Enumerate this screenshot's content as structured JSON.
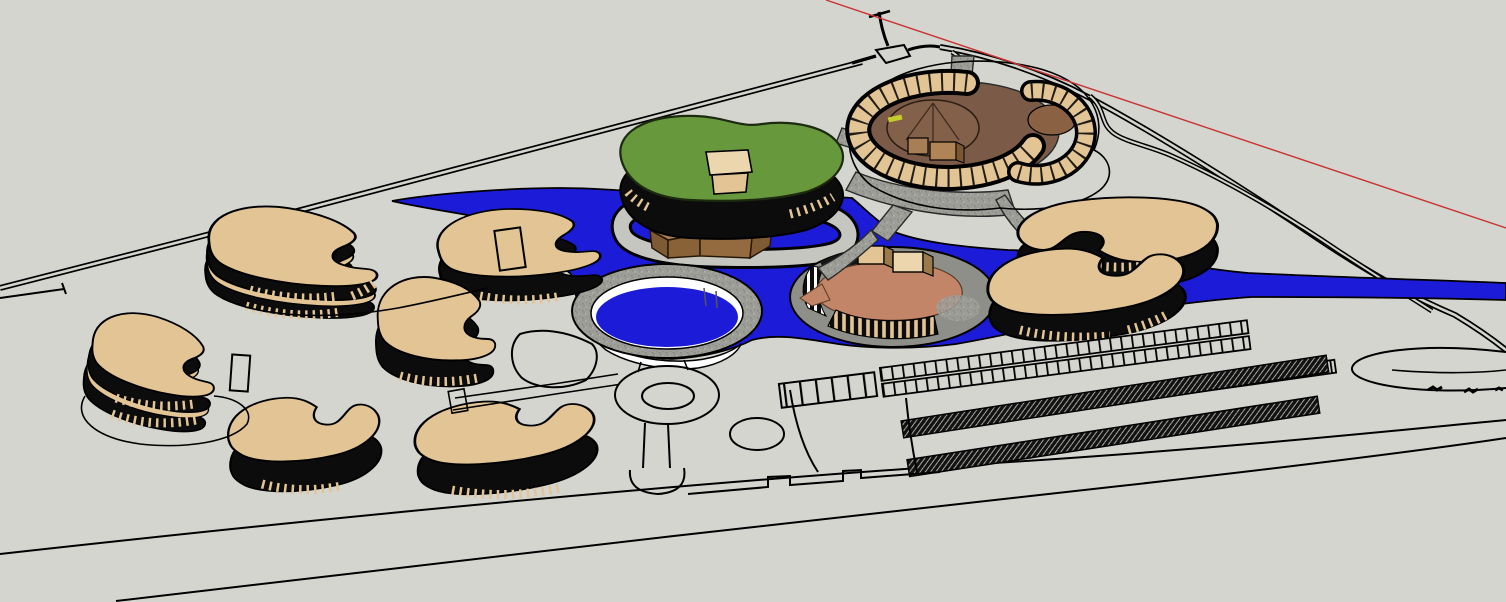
{
  "scene": {
    "title": "Aerial 3D site model of a resort campus with bean-shaped buildings, river and circular pool",
    "style": "sketchup-like hidden-line render with flat color materials",
    "view": "aerial oblique from south-west",
    "palette": {
      "ground": "#d5d5d0",
      "outline": "#000000",
      "water": "#1c1cd8",
      "tan": "#e2c495",
      "tan-light": "#ecd6ae",
      "facade": "#0c0c0c",
      "roof-green": "#67993c",
      "courtyard": "#7b5a47",
      "dome": "#82604a",
      "cube-top": "#a87e57",
      "cube-front": "#8a6238",
      "cube-side": "#7e5a35",
      "island-mound": "#c28567",
      "platform": "#8f8f89",
      "path-gray": "#9e9e98",
      "loop-band": "#c6c6c0",
      "white": "#ffffff",
      "axis-red": "#c83232"
    },
    "objects": [
      {
        "id": "ground-plane",
        "kind": "terrain",
        "label": "flat light-gray site ground"
      },
      {
        "id": "perimeter-road-west",
        "kind": "road",
        "label": "straight double-line road along upper-left site edge"
      },
      {
        "id": "perimeter-road-east",
        "kind": "road",
        "label": "double-line road sweeping down the right side"
      },
      {
        "id": "north-junction",
        "kind": "road",
        "label": "small road junction with island loop at top center"
      },
      {
        "id": "red-axis-line",
        "kind": "guide",
        "label": "thin red modeling axis line, upper right"
      },
      {
        "id": "river",
        "kind": "water",
        "label": "blue river crossing the site from left to right edge"
      },
      {
        "id": "circular-pool",
        "kind": "water",
        "label": "round sunken pool with stone ring and white wall"
      },
      {
        "id": "island-pavilion",
        "kind": "building",
        "label": "oval island platform with salmon mound and colonnade"
      },
      {
        "id": "green-roof-hall",
        "kind": "building",
        "label": "large kidney hall with green roof and tan entrance"
      },
      {
        "id": "center-block-building",
        "kind": "building",
        "label": "brown cubic cluster inside looped walkway"
      },
      {
        "id": "loop-walkway",
        "kind": "path",
        "label": "stadium-shaped walkway loop ringed by water"
      },
      {
        "id": "courtyard-complex",
        "kind": "building",
        "label": "two C-shaped tan walls enclosing brown courtyard and dome"
      },
      {
        "id": "kidney-buildings",
        "kind": "building-group",
        "label": "eight tan kidney-shaped buildings with dark striped facades",
        "count": 8
      },
      {
        "id": "footbridges",
        "kind": "path",
        "label": "speckled gray footpaths and bridges over the water"
      },
      {
        "id": "roundabout",
        "kind": "road",
        "label": "small oval roundabout south of the pool"
      },
      {
        "id": "parking-stalls",
        "kind": "parking",
        "label": "rows of small parking stalls, bottom center-right"
      },
      {
        "id": "hedge-strips",
        "kind": "planting",
        "label": "two dark cross-hatched hedge strips in parking lot"
      },
      {
        "id": "east-loop-road",
        "kind": "road",
        "label": "small looping drive with car marks at far right"
      }
    ]
  }
}
